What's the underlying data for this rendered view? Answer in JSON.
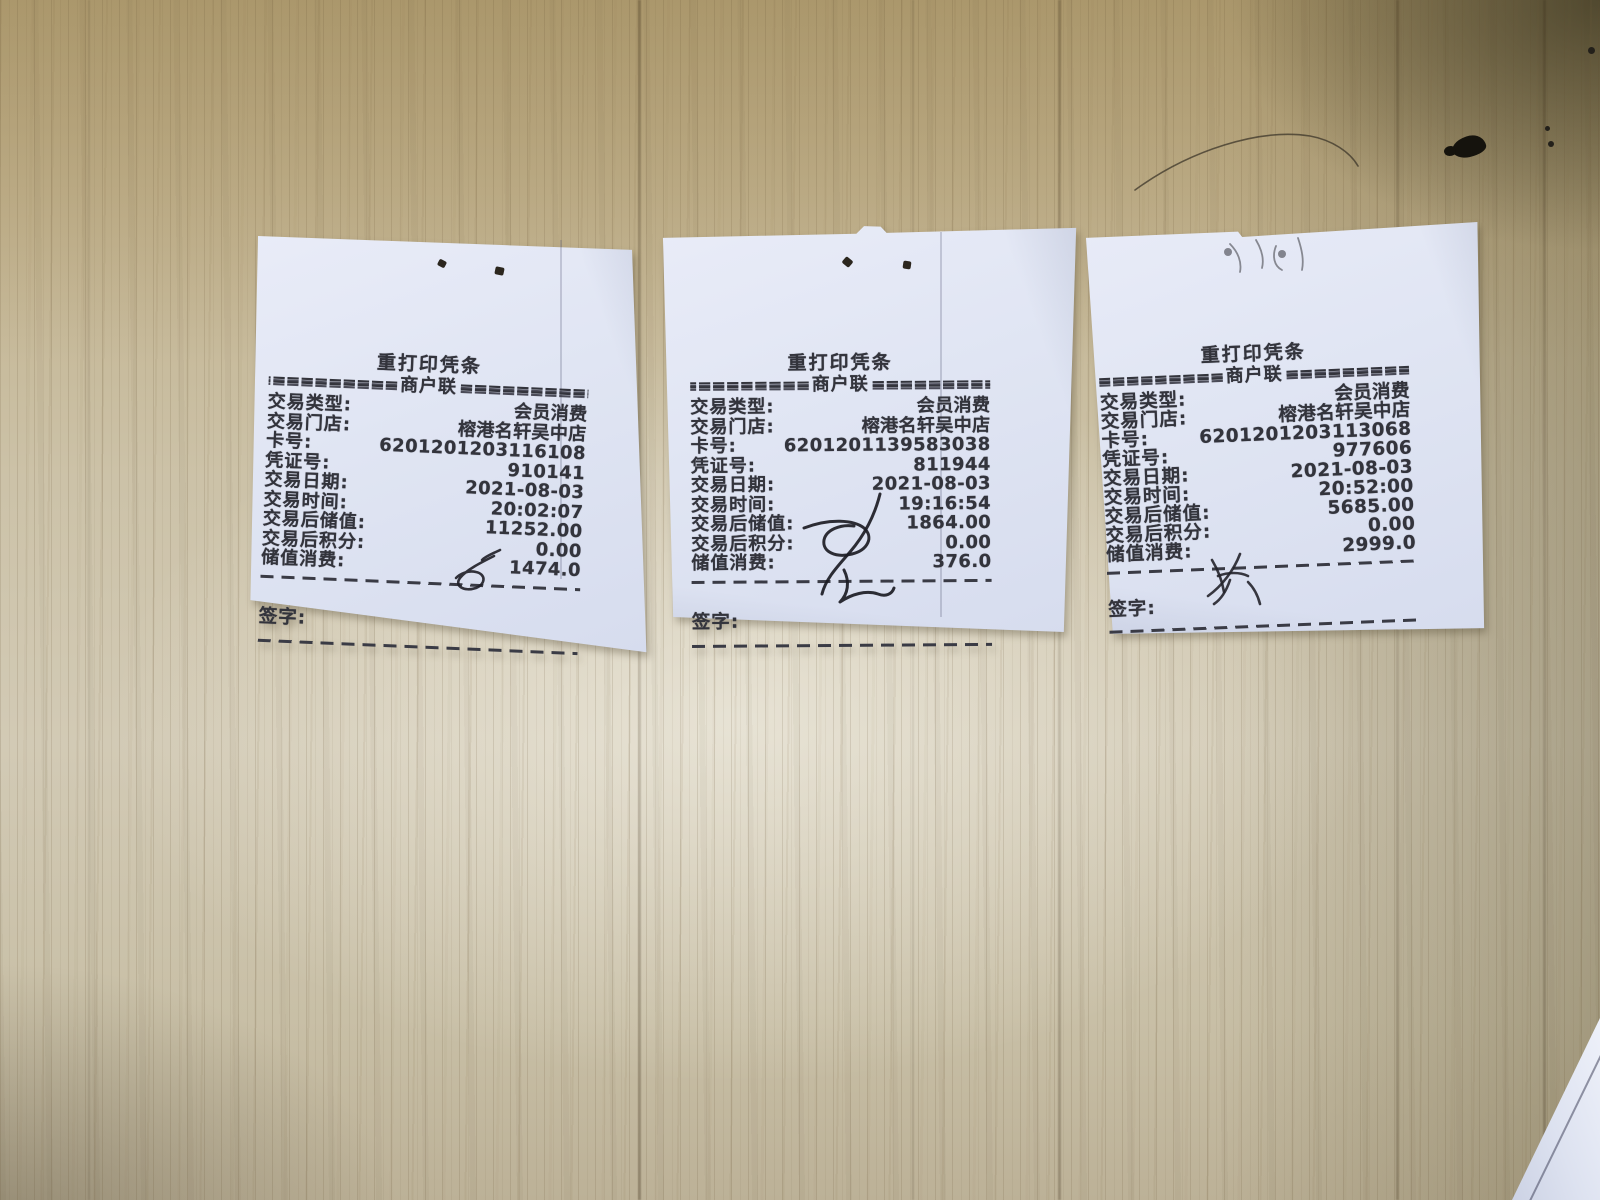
{
  "colors": {
    "wood_base": "#c4b797",
    "paper": "#e0e5f3",
    "ink": "#33343c"
  },
  "receipts": [
    {
      "title": "重打印凭条",
      "separator": {
        "eq_left": "===========",
        "copy_label": "商户联",
        "eq_right": "==========="
      },
      "rows": [
        {
          "label": "交易类型:",
          "value": "会员消费"
        },
        {
          "label": "交易门店:",
          "value": "榕港名轩吴中店"
        },
        {
          "label": "卡号:",
          "value": "6201201203116108"
        },
        {
          "label": "凭证号:",
          "value": "910141"
        },
        {
          "label": "交易日期:",
          "value": "2021-08-03"
        },
        {
          "label": "交易时间:",
          "value": "20:02:07"
        },
        {
          "label": "交易后储值:",
          "value": "11252.00"
        },
        {
          "label": "交易后积分:",
          "value": "0.00"
        },
        {
          "label": "储值消费:",
          "value": "1474.0"
        }
      ],
      "sign_label": "签字:"
    },
    {
      "title": "重打印凭条",
      "separator": {
        "eq_left": "===========",
        "copy_label": "商户联",
        "eq_right": "==========="
      },
      "rows": [
        {
          "label": "交易类型:",
          "value": "会员消费"
        },
        {
          "label": "交易门店:",
          "value": "榕港名轩吴中店"
        },
        {
          "label": "卡号:",
          "value": "6201201139583038"
        },
        {
          "label": "凭证号:",
          "value": "811944"
        },
        {
          "label": "交易日期:",
          "value": "2021-08-03"
        },
        {
          "label": "交易时间:",
          "value": "19:16:54"
        },
        {
          "label": "交易后储值:",
          "value": "1864.00"
        },
        {
          "label": "交易后积分:",
          "value": "0.00"
        },
        {
          "label": "储值消费:",
          "value": "376.0"
        }
      ],
      "sign_label": "签字:"
    },
    {
      "title": "重打印凭条",
      "separator": {
        "eq_left": "===========",
        "copy_label": "商户联",
        "eq_right": "==========="
      },
      "rows": [
        {
          "label": "交易类型:",
          "value": "会员消费"
        },
        {
          "label": "交易门店:",
          "value": "榕港名轩吴中店"
        },
        {
          "label": "卡号:",
          "value": "6201201203113068"
        },
        {
          "label": "凭证号:",
          "value": "977606"
        },
        {
          "label": "交易日期:",
          "value": "2021-08-03"
        },
        {
          "label": "交易时间:",
          "value": "20:52:00"
        },
        {
          "label": "交易后储值:",
          "value": "5685.00"
        },
        {
          "label": "交易后积分:",
          "value": "0.00"
        },
        {
          "label": "储值消费:",
          "value": "2999.0"
        }
      ],
      "sign_label": "签字:"
    }
  ]
}
